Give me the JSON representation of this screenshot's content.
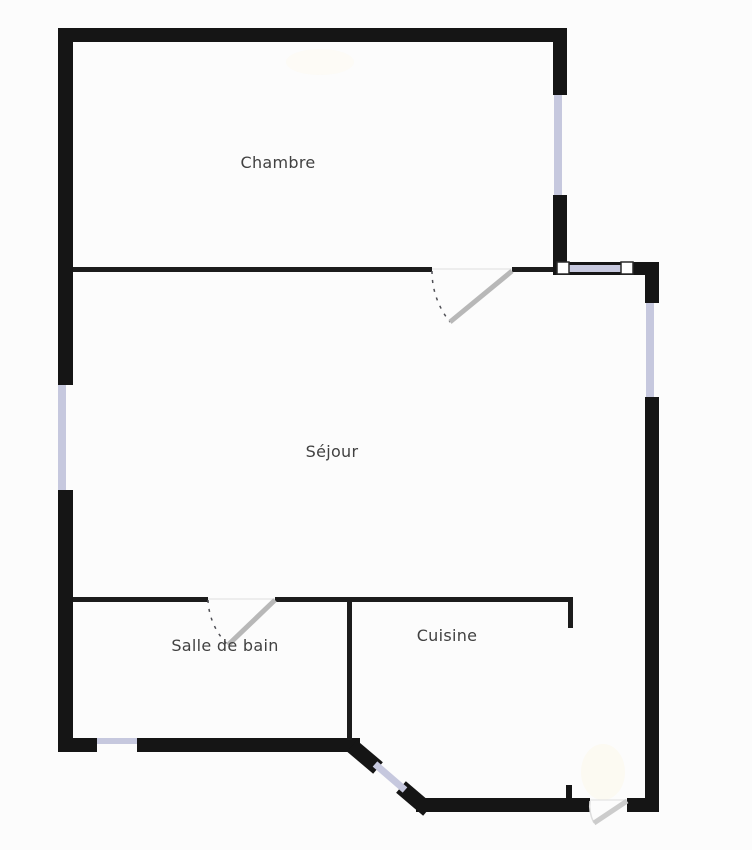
{
  "plan": {
    "type": "floor-plan",
    "language": "fr",
    "rooms": {
      "chambre": {
        "label": "Chambre"
      },
      "sejour": {
        "label": "Séjour"
      },
      "salle_de_bain": {
        "label": "Salle de bain"
      },
      "cuisine": {
        "label": "Cuisine"
      }
    },
    "colors": {
      "wall": "#151515",
      "window": "#c6c8de",
      "door_leaf": "#b8b8b8",
      "label_text": "#414141",
      "background": "#fcfcfc"
    },
    "features": {
      "windows_count": 6,
      "doors_count": 3
    }
  }
}
